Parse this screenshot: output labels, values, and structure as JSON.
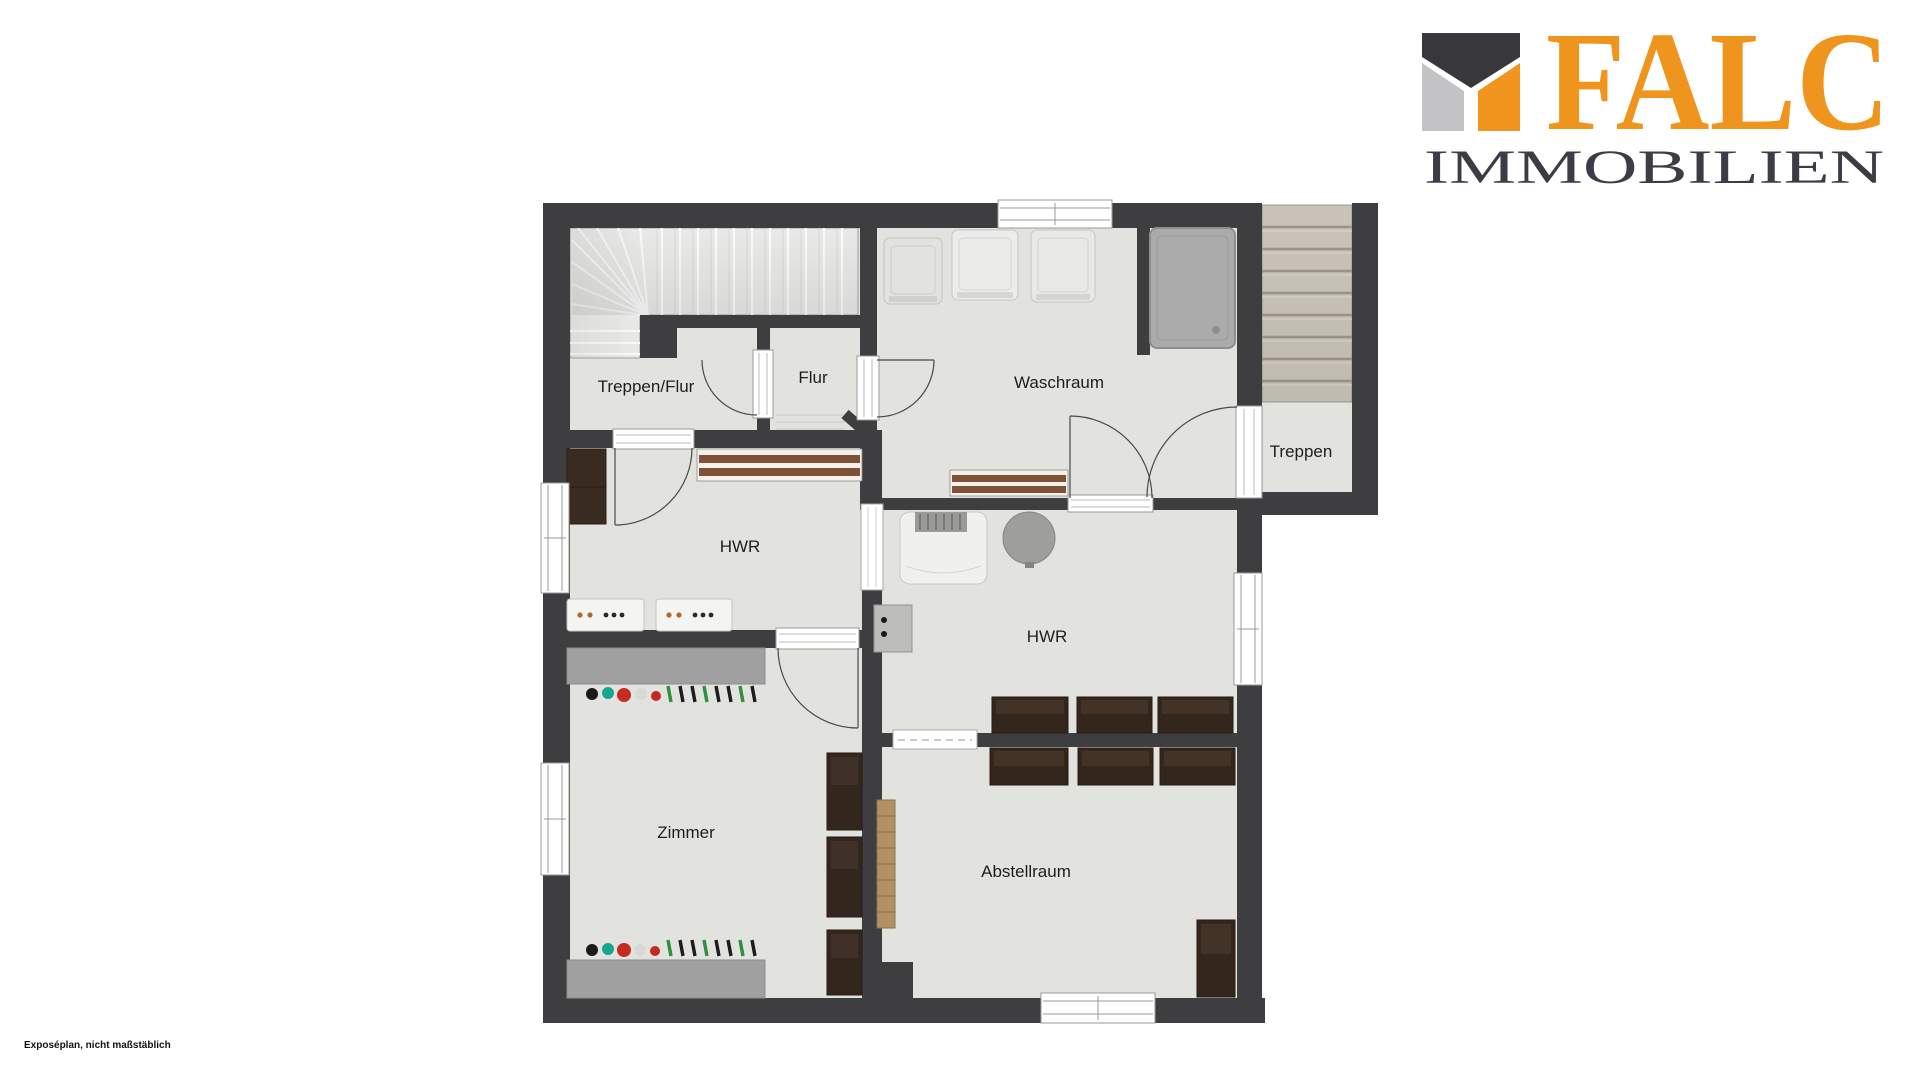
{
  "logo": {
    "brand": "FALC",
    "subtitle": "IMMOBILIEN",
    "brand_color": "#EF941C",
    "subtitle_color": "#3C3C46",
    "mark_colors": {
      "dark": "#38383C",
      "gray": "#C4C4C6",
      "orange": "#F0951D"
    }
  },
  "footnote": "Exposéplan, nicht maßstäblich",
  "floor_plan": {
    "rooms": [
      {
        "label": "Treppen/Flur"
      },
      {
        "label": "Flur"
      },
      {
        "label": "Waschraum"
      },
      {
        "label": "Treppen"
      },
      {
        "label": "HWR"
      },
      {
        "label": "HWR"
      },
      {
        "label": "Zimmer"
      },
      {
        "label": "Abstellraum"
      }
    ],
    "colors": {
      "wall": "#3E3E40",
      "floor": "#E2E2DE",
      "stairs_light": "#E9E9E7",
      "stairs_beige": "#C9C3B9",
      "radiator_brown": "#7E5236",
      "furniture_dark": "#33261C",
      "wood": "#B29064",
      "shower_gray": "#ABABAB",
      "label": "#1E1E1E"
    }
  }
}
